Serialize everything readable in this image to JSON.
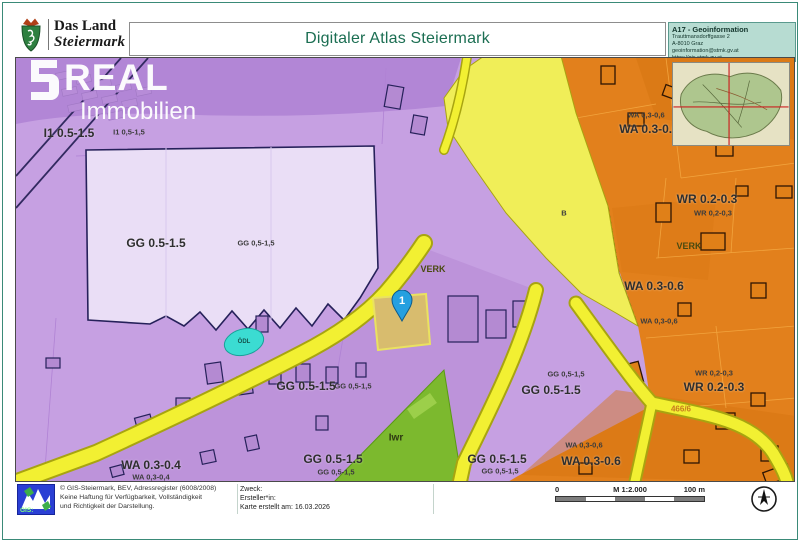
{
  "header": {
    "logo": {
      "line1": "Das Land",
      "line2": "Steiermark"
    },
    "title": "Digitaler Atlas Steiermark",
    "info_box": {
      "title": "A17 - Geoinformation",
      "address1": "Trauttmansdorffgasse 2",
      "address2": "A-8010 Graz",
      "email": "geoinformation@stmk.gv.at",
      "url": "https://gis.stmk.gv.at"
    }
  },
  "watermark": {
    "brand": "REAL",
    "sub": "Immobilien"
  },
  "icons": {
    "coat_of_arms": "steiermark-coat-of-arms",
    "watermark_logo": "s-real-logo",
    "overview_map": "styria-overview-map",
    "marker_pin": "map-pin",
    "gis_logo": "gis-steiermark-logo",
    "north_arrow": "compass-north-arrow"
  },
  "map": {
    "marker": {
      "label": "1"
    },
    "colors": {
      "zone_commercial_purple": "#c6a0e2",
      "zone_purple_dark": "#b286d6",
      "zone_residential_orange": "#e2801c",
      "road_yellow": "#f2f032",
      "traffic_area_yellow": "#f0ee58",
      "green_area": "#7cb92e",
      "water_symbol_cyan": "#3bdcd2",
      "marker_blue": "#25a0e0",
      "parcel_tan": "#d8bc6e"
    },
    "labels": [
      {
        "text": "I1 0.5-1.5",
        "x": 53,
        "y": 75,
        "cls": "bold"
      },
      {
        "text": "I1 0,5-1,5",
        "x": 113,
        "y": 74,
        "cls": "small"
      },
      {
        "text": "GG 0.5-1.5",
        "x": 140,
        "y": 185,
        "cls": "bold"
      },
      {
        "text": "GG 0,5-1,5",
        "x": 240,
        "y": 185,
        "cls": "small"
      },
      {
        "text": "VERK",
        "x": 417,
        "y": 211,
        "cls": "verk"
      },
      {
        "text": "B",
        "x": 548,
        "y": 155,
        "cls": "small"
      },
      {
        "text": "VERK",
        "x": 673,
        "y": 188,
        "cls": "verk"
      },
      {
        "text": "WA 0,3-0,6",
        "x": 630,
        "y": 57,
        "cls": "small"
      },
      {
        "text": "WA 0.3-0.6",
        "x": 633,
        "y": 71,
        "cls": "bold"
      },
      {
        "text": "WR 0.2-0.3",
        "x": 691,
        "y": 141,
        "cls": "bold"
      },
      {
        "text": "WR 0,2-0,3",
        "x": 697,
        "y": 155,
        "cls": "small"
      },
      {
        "text": "WA 0.3-0.6",
        "x": 638,
        "y": 228,
        "cls": "bold"
      },
      {
        "text": "WA 0,3-0,6",
        "x": 643,
        "y": 263,
        "cls": "small"
      },
      {
        "text": "WR 0,2-0,3",
        "x": 698,
        "y": 315,
        "cls": "small"
      },
      {
        "text": "WR 0.2-0.3",
        "x": 698,
        "y": 329,
        "cls": "bold"
      },
      {
        "text": "GG 0.5-1.5",
        "x": 290,
        "y": 328,
        "cls": "bold"
      },
      {
        "text": "GG 0,5-1,5",
        "x": 337,
        "y": 328,
        "cls": "small"
      },
      {
        "text": "GG 0,5-1,5",
        "x": 550,
        "y": 316,
        "cls": "small"
      },
      {
        "text": "GG 0.5-1.5",
        "x": 535,
        "y": 332,
        "cls": "bold"
      },
      {
        "text": "Iwr",
        "x": 380,
        "y": 380,
        "cls": "iwr"
      },
      {
        "text": "GG 0.5-1.5",
        "x": 317,
        "y": 401,
        "cls": "bold"
      },
      {
        "text": "GG 0,5-1,5",
        "x": 320,
        "y": 414,
        "cls": "small"
      },
      {
        "text": "GG 0.5-1.5",
        "x": 481,
        "y": 401,
        "cls": "bold"
      },
      {
        "text": "GG 0,5-1,5",
        "x": 484,
        "y": 413,
        "cls": "small"
      },
      {
        "text": "WA 0,3-0,6",
        "x": 568,
        "y": 387,
        "cls": "small"
      },
      {
        "text": "WA 0.3-0.6",
        "x": 575,
        "y": 403,
        "cls": "bold"
      },
      {
        "text": "WA 0.3-0.4",
        "x": 135,
        "y": 407,
        "cls": "bold"
      },
      {
        "text": "WA 0,3-0,4",
        "x": 135,
        "y": 419,
        "cls": "small"
      },
      {
        "text": "ÖDL",
        "x": 228,
        "y": 284,
        "cls": "odl"
      },
      {
        "text": "466/6",
        "x": 665,
        "y": 351,
        "cls": "parcel"
      }
    ]
  },
  "footer": {
    "gis_logo_text": "GIS:",
    "attribution": [
      "© GIS-Steiermark, BEV, Adressregister (6008/2008)",
      "Keine Haftung für Verfügbarkeit, Vollständigkeit",
      "und Richtigkeit der Darstellung."
    ],
    "zweck_label": "Zweck:",
    "ersteller_label": "Ersteller*in:",
    "created_label": "Karte erstellt am: 16.03.2026",
    "scale": {
      "start": "0",
      "ratio": "M 1:2.000",
      "end": "100 m"
    }
  }
}
